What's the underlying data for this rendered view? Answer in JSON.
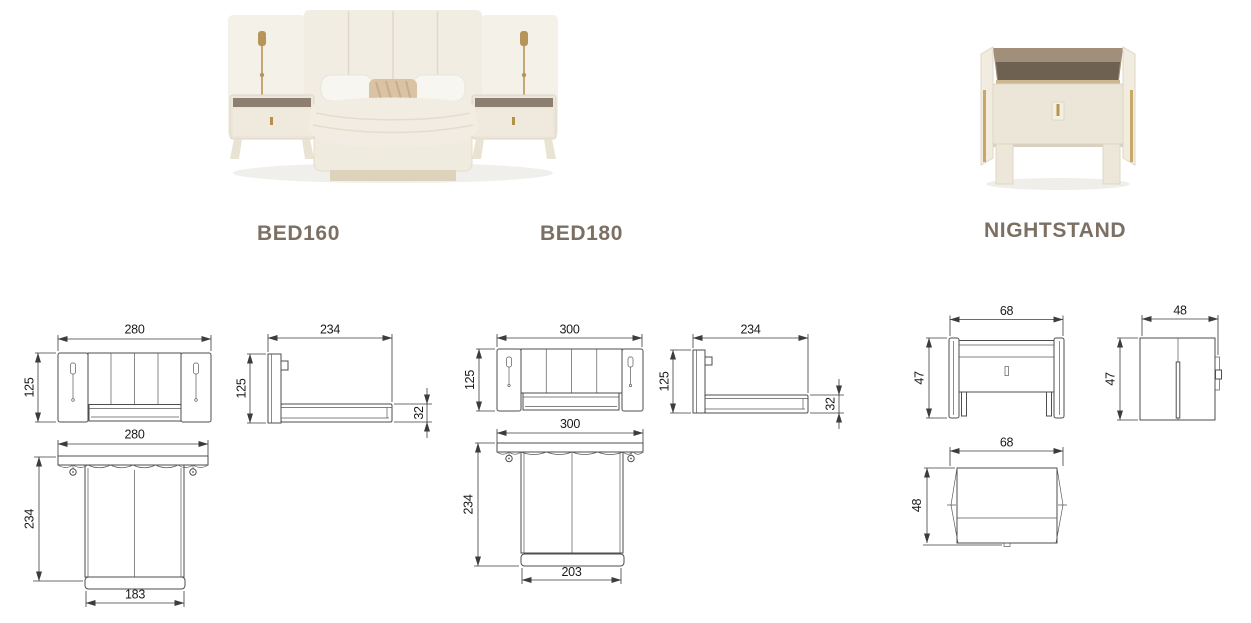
{
  "page": {
    "background": "#ffffff"
  },
  "colors": {
    "label_text": "#7c7064",
    "drawing_line": "#3c3c3c",
    "dimension_text": "#1a1a1a",
    "brass_accent": "#b7955a",
    "upholstery_cream": "#f1ede4",
    "shelf_bronze": "#6e6152"
  },
  "products": {
    "bed160": {
      "label": "BED160",
      "dims": {
        "front_width": "280",
        "front_height": "125",
        "side_depth": "234",
        "side_height": "125",
        "side_base_height": "32",
        "top_width": "280",
        "top_depth": "234",
        "top_base_width": "183"
      }
    },
    "bed180": {
      "label": "BED180",
      "dims": {
        "front_width": "300",
        "front_height": "125",
        "side_depth": "234",
        "side_height": "125",
        "side_base_height": "32",
        "top_width": "300",
        "top_depth": "234",
        "top_base_width": "203"
      }
    },
    "nightstand": {
      "label": "NIGHTSTAND",
      "dims": {
        "front_width": "68",
        "front_height": "47",
        "side_depth": "48",
        "side_height": "47",
        "top_width": "68",
        "top_depth": "48"
      }
    }
  }
}
